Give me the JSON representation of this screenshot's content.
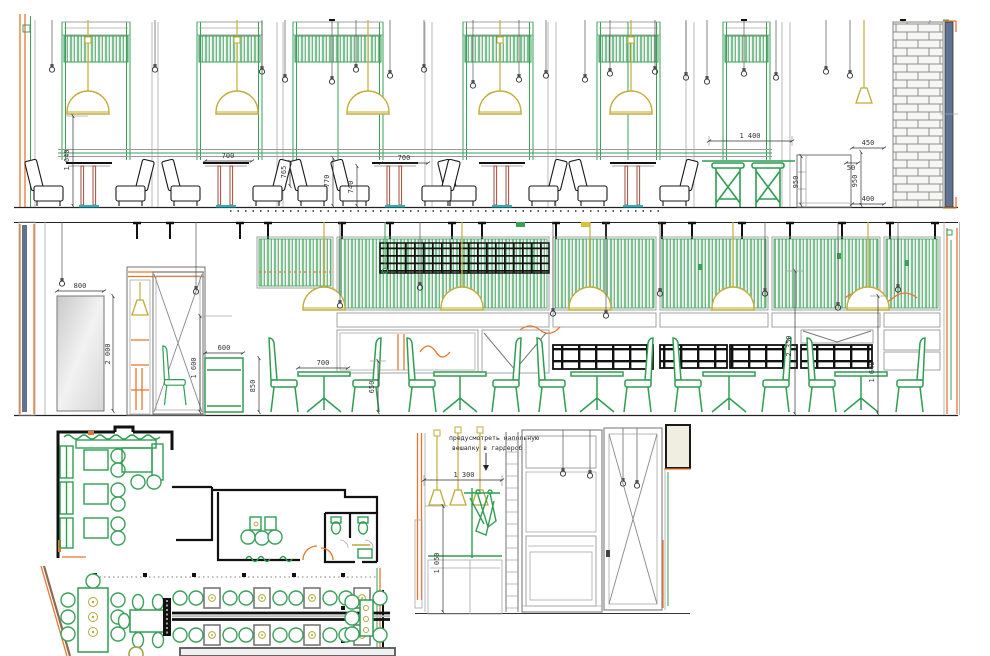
{
  "title": "Cafe interior — wall elevations and floor plan",
  "colors": {
    "green": "#3aa159",
    "light_green": "#7cc28f",
    "black": "#1a1a1a",
    "gray": "#9a9a9a",
    "orange": "#e8762c",
    "lamp_yellow": "#c2ae3a",
    "wood_red": "#a84a38",
    "teal": "#2ab0b8",
    "blue_gray": "#5f7390",
    "cream": "#efeee0"
  },
  "top_elevation": {
    "dims": {
      "d1640": "1 640",
      "d700a": "700",
      "d765": "765",
      "d770": "770",
      "d740": "740",
      "d700b": "700",
      "d1400": "1 400",
      "d450": "450",
      "d50": "50",
      "d950a": "950",
      "d950b": "950",
      "d400": "400"
    }
  },
  "middle_elevation": {
    "dims": {
      "d800": "800",
      "d2000": "2 000",
      "d600": "600",
      "d1600": "1 600",
      "d850": "850",
      "d700": "700",
      "d650": "650",
      "d2350": "2 350",
      "d1640": "1 640"
    }
  },
  "wardrobe_elevation": {
    "note_line1": "предусмотреть напольную",
    "note_line2": "вешалку в гардероб",
    "dims": {
      "d1300": "1 300",
      "d1050": "1 050"
    }
  }
}
